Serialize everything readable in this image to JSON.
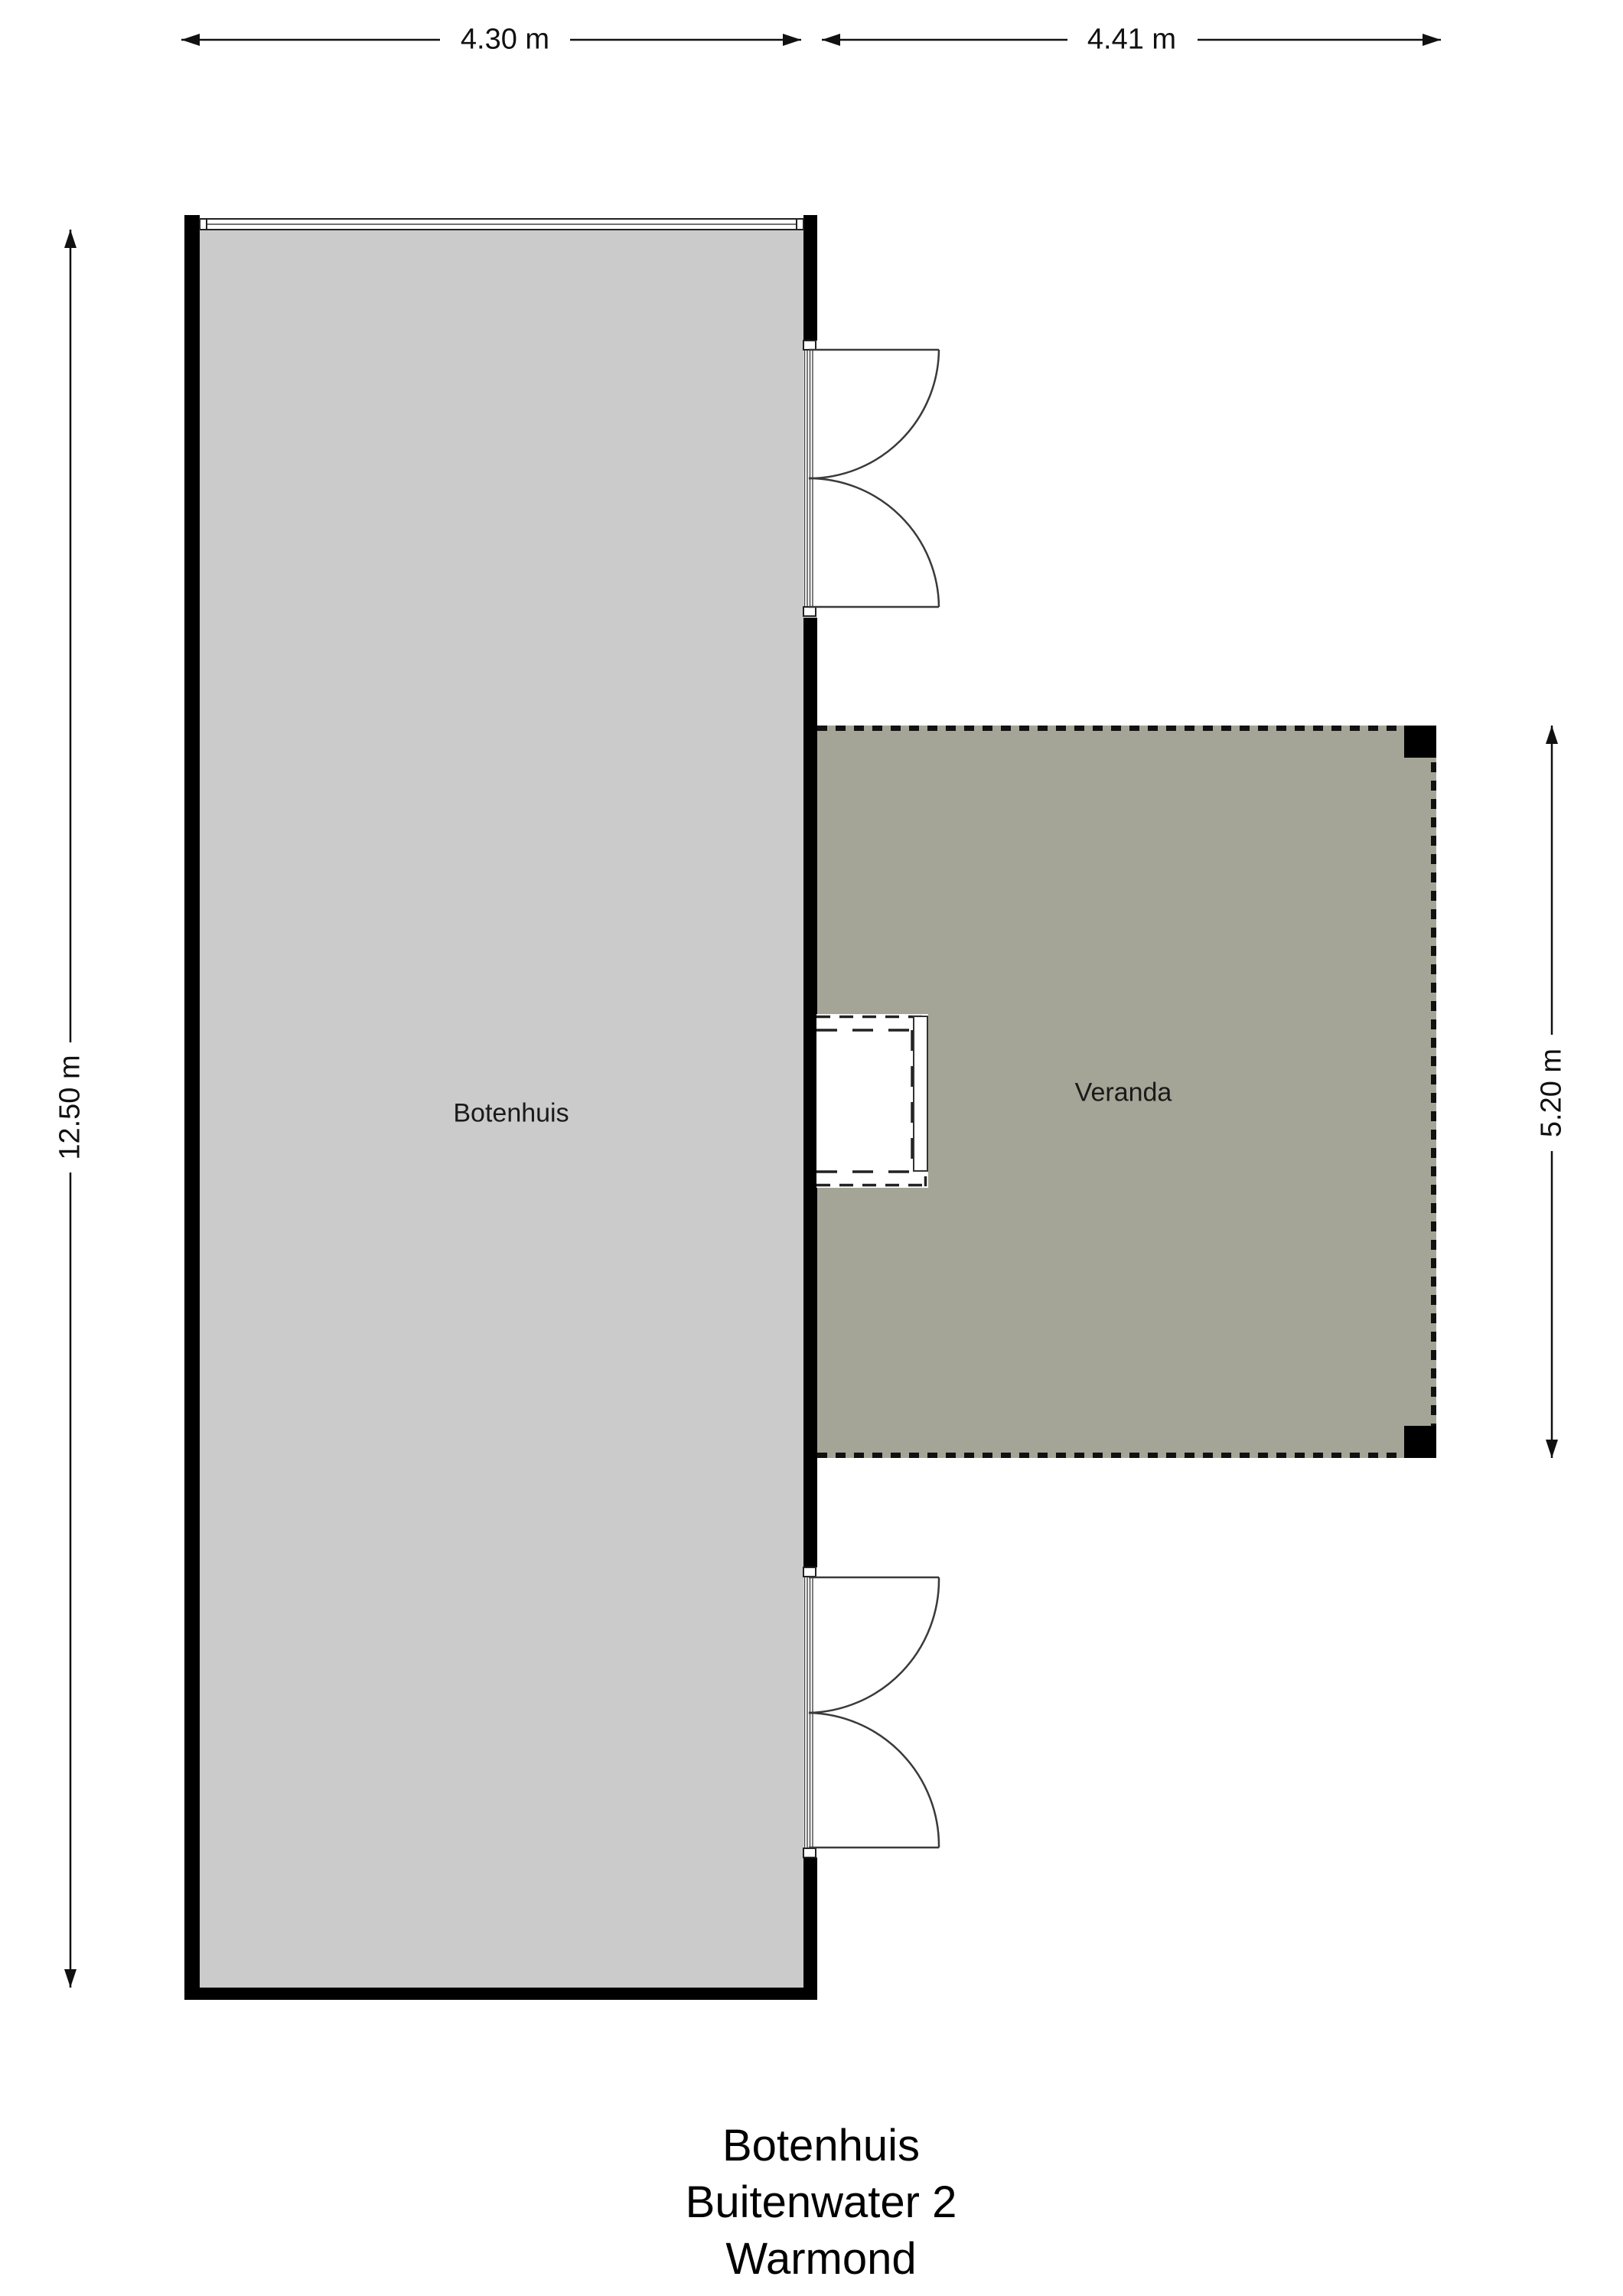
{
  "plan": {
    "rooms": [
      {
        "id": "botenhuis",
        "label": "Botenhuis"
      },
      {
        "id": "veranda",
        "label": "Veranda"
      }
    ],
    "dimensions": {
      "botenhuis_width": "4.30 m",
      "veranda_width": "4.41 m",
      "botenhuis_depth": "12.50 m",
      "veranda_depth": "5.20 m"
    },
    "footer": {
      "lines": [
        "Botenhuis",
        "Buitenwater 2",
        "Warmond"
      ]
    },
    "colors": {
      "wall": "#000000",
      "botenhuis_fill": "#cbcbcb",
      "veranda_fill": "#a4a596",
      "line": "#3a3a3a",
      "dash": "#111111",
      "text": "#111111",
      "background": "#ffffff"
    }
  }
}
